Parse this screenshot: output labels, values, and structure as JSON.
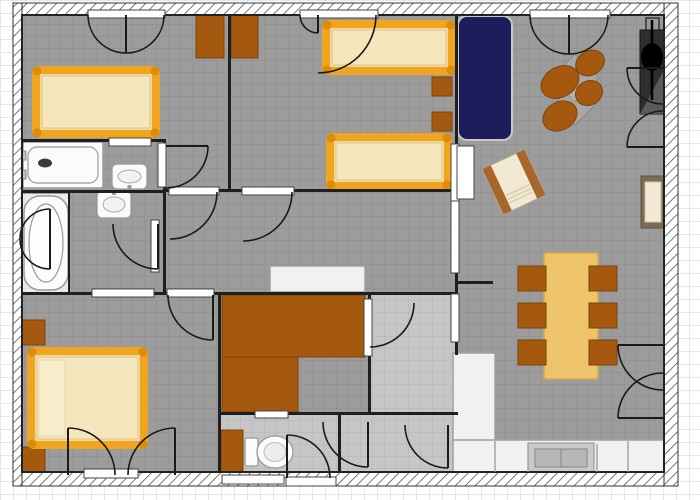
{
  "palette": {
    "paper": "#ffffff",
    "floor": "#9c9c9c",
    "floor_light": "#c6c6c6",
    "niche": "#ececec",
    "wall": "#1f1f1f",
    "hatch_line": "#555555",
    "wood": "#a4590f",
    "wood_dark": "#7d4408",
    "bed_frame": "#f0a41f",
    "bed_knob": "#dd8d05",
    "mattress": "#efd9a4",
    "mattress_light": "#f5e6bd",
    "pillow": "#f8edcb",
    "sofa": "#1d1d5c",
    "sofa_edge": "#c9c9c9",
    "table": "#edc469",
    "cream": "#f1e9d3",
    "arm_brown": "#a9662b",
    "chair_frame": "#7d6b58",
    "fixture": "#fbfbfb",
    "fixture_stroke": "#999999",
    "counter": "#f1f1f1",
    "counter_stroke": "#a0a0a0",
    "sink_gray": "#c9c9c9",
    "sink_gray2": "#b7b7b7",
    "dark_obj": "#2e2e2e",
    "black": "#000000",
    "door_line": "#1a1a1a",
    "threshold": "#ffffff",
    "threshold_stroke": "#444444",
    "grid_line": "rgba(0,0,0,0.09)"
  },
  "floorplan": {
    "canvas": {
      "width": 700,
      "height": 500
    },
    "exterior_walls": [
      {
        "name": "wall-top",
        "x": 13,
        "y": 3,
        "w": 665,
        "h": 12
      },
      {
        "name": "wall-bottom",
        "x": 13,
        "y": 472,
        "w": 665,
        "h": 14
      },
      {
        "name": "wall-left",
        "x": 13,
        "y": 3,
        "w": 9,
        "h": 483
      },
      {
        "name": "wall-right",
        "x": 664,
        "y": 3,
        "w": 14,
        "h": 483
      }
    ],
    "floors": [
      {
        "name": "floor-main",
        "x": 22,
        "y": 15,
        "w": 642,
        "h": 457,
        "fill": "floor"
      },
      {
        "name": "floor-bath-niche",
        "x": 22,
        "y": 194,
        "w": 47,
        "h": 98,
        "fill": "niche"
      },
      {
        "name": "floor-utility",
        "x": 371,
        "y": 295,
        "w": 84,
        "h": 117,
        "fill": "floor_light"
      },
      {
        "name": "floor-lobby",
        "x": 341,
        "y": 415,
        "w": 114,
        "h": 57,
        "fill": "floor_light"
      },
      {
        "name": "floor-wc",
        "x": 221,
        "y": 415,
        "w": 117,
        "h": 57,
        "fill": "floor_light"
      }
    ],
    "interior_walls": [
      {
        "name": "wall-bed1-bed2",
        "x": 228,
        "y": 15,
        "w": 3,
        "h": 176
      },
      {
        "name": "wall-beds-living",
        "x": 455,
        "y": 15,
        "w": 3,
        "h": 340
      },
      {
        "name": "wall-bed1-bath1",
        "x": 22,
        "y": 139,
        "w": 144,
        "h": 3
      },
      {
        "name": "wall-bath1-bath2",
        "x": 22,
        "y": 190,
        "w": 144,
        "h": 3
      },
      {
        "name": "wall-bath-vestibule",
        "x": 163,
        "y": 139,
        "w": 3,
        "h": 156
      },
      {
        "name": "wall-hall-top",
        "x": 166,
        "y": 189,
        "w": 292,
        "h": 3
      },
      {
        "name": "wall-hall-bottom",
        "x": 22,
        "y": 292,
        "w": 436,
        "h": 3
      },
      {
        "name": "wall-bed3-wc",
        "x": 218,
        "y": 292,
        "w": 3,
        "h": 188
      },
      {
        "name": "wall-storage-utility",
        "x": 368,
        "y": 292,
        "w": 3,
        "h": 123
      },
      {
        "name": "wall-storage-wc",
        "x": 218,
        "y": 412,
        "w": 240,
        "h": 3
      },
      {
        "name": "wall-wc-lobby",
        "x": 338,
        "y": 412,
        "w": 3,
        "h": 68
      },
      {
        "name": "wall-living-stub",
        "x": 455,
        "y": 281,
        "w": 38,
        "h": 3
      },
      {
        "name": "wall-tub-niche",
        "x": 68,
        "y": 191,
        "w": 2,
        "h": 101
      }
    ],
    "openings": [
      {
        "name": "threshold-bed1-terrace",
        "x": 88,
        "y": 10,
        "w": 77,
        "h": 8
      },
      {
        "name": "threshold-bed2-terrace",
        "x": 300,
        "y": 10,
        "w": 78,
        "h": 8
      },
      {
        "name": "threshold-living-terrace",
        "x": 530,
        "y": 10,
        "w": 80,
        "h": 8
      },
      {
        "name": "towel-rail-bath1",
        "x": 109,
        "y": 138,
        "w": 42,
        "h": 8
      },
      {
        "name": "threshold-bath1-door",
        "x": 158,
        "y": 143,
        "w": 8,
        "h": 44
      },
      {
        "name": "threshold-bed1-hall",
        "x": 169,
        "y": 187,
        "w": 50,
        "h": 8
      },
      {
        "name": "threshold-bed2-hall",
        "x": 242,
        "y": 187,
        "w": 52,
        "h": 8
      },
      {
        "name": "threshold-bath2-door",
        "x": 151,
        "y": 220,
        "w": 8,
        "h": 52
      },
      {
        "name": "threshold-bath2-bed3",
        "x": 92,
        "y": 289,
        "w": 62,
        "h": 8
      },
      {
        "name": "threshold-bed3-hall",
        "x": 167,
        "y": 289,
        "w": 47,
        "h": 8
      },
      {
        "name": "threshold-living-upper",
        "x": 451,
        "y": 144,
        "w": 8,
        "h": 57
      },
      {
        "name": "threshold-hall-living",
        "x": 451,
        "y": 201,
        "w": 8,
        "h": 72
      },
      {
        "name": "threshold-utility-dining",
        "x": 451,
        "y": 294,
        "w": 8,
        "h": 48
      },
      {
        "name": "threshold-storage-utility",
        "x": 364,
        "y": 299,
        "w": 8,
        "h": 57
      },
      {
        "name": "jamb-living-upper",
        "x": 457,
        "y": 146,
        "w": 17,
        "h": 53
      },
      {
        "name": "threshold-bed3-terrace",
        "x": 84,
        "y": 469,
        "w": 54,
        "h": 9
      },
      {
        "name": "window-bottom-1",
        "x": 222,
        "y": 475,
        "w": 62,
        "h": 9
      },
      {
        "name": "window-bottom-2",
        "x": 286,
        "y": 477,
        "w": 50,
        "h": 9
      },
      {
        "name": "shelf-wc",
        "x": 255,
        "y": 411,
        "w": 33,
        "h": 7
      }
    ],
    "doors": [
      {
        "name": "door-bed1-terrace-left",
        "hx": 126,
        "hy": 15,
        "r": 38,
        "a1": 90,
        "a2": 180,
        "leaf": true
      },
      {
        "name": "door-bed1-terrace-right",
        "hx": 126,
        "hy": 15,
        "r": 38,
        "a1": 90,
        "a2": 0,
        "leaf": false
      },
      {
        "name": "door-bed2-terrace-left",
        "hx": 318,
        "hy": 15,
        "r": 18,
        "a1": 90,
        "a2": 180,
        "leaf": true
      },
      {
        "name": "door-bed2-terrace-right",
        "hx": 318,
        "hy": 15,
        "r": 58,
        "a1": 90,
        "a2": 0,
        "leaf": false
      },
      {
        "name": "door-living-terrace-left",
        "hx": 569,
        "hy": 15,
        "r": 39,
        "a1": 90,
        "a2": 180,
        "leaf": true
      },
      {
        "name": "door-living-terrace-right",
        "hx": 569,
        "hy": 15,
        "r": 39,
        "a1": 90,
        "a2": 0,
        "leaf": false
      },
      {
        "name": "door-bed1-hall",
        "hx": 170,
        "hy": 192,
        "r": 47,
        "a1": 0,
        "a2": 90,
        "leaf": false
      },
      {
        "name": "door-bed2-hall",
        "hx": 243,
        "hy": 192,
        "r": 49,
        "a1": 0,
        "a2": 90,
        "leaf": false
      },
      {
        "name": "door-bath1",
        "hx": 166,
        "hy": 146,
        "r": 42,
        "a1": 0,
        "a2": 90,
        "leaf": true
      },
      {
        "name": "door-bath2",
        "hx": 158,
        "hy": 224,
        "r": 45,
        "a1": 90,
        "a2": 180,
        "leaf": true
      },
      {
        "name": "screen-tub-upper",
        "hx": 50,
        "hy": 239,
        "r": 30,
        "a1": 270,
        "a2": 180,
        "leaf": true
      },
      {
        "name": "screen-tub-lower",
        "hx": 50,
        "hy": 239,
        "r": 30,
        "a1": 90,
        "a2": 180,
        "leaf": true
      },
      {
        "name": "door-bed3-hall",
        "hx": 213,
        "hy": 295,
        "r": 45,
        "a1": 90,
        "a2": 180,
        "leaf": true
      },
      {
        "name": "door-bed3-terrace-left",
        "hx": 68,
        "hy": 475,
        "r": 47,
        "a1": 270,
        "a2": 0,
        "leaf": true
      },
      {
        "name": "door-bed3-terrace-right",
        "hx": 175,
        "hy": 475,
        "r": 47,
        "a1": 270,
        "a2": 180,
        "leaf": true
      },
      {
        "name": "door-wc",
        "hx": 287,
        "hy": 478,
        "r": 43,
        "a1": 270,
        "a2": 0,
        "leaf": true
      },
      {
        "name": "door-lobby-1",
        "hx": 368,
        "hy": 422,
        "r": 45,
        "a1": 90,
        "a2": 180,
        "leaf": true
      },
      {
        "name": "door-lobby-2",
        "hx": 448,
        "hy": 425,
        "r": 43,
        "a1": 90,
        "a2": 180,
        "leaf": true
      },
      {
        "name": "door-storage-utility",
        "hx": 370,
        "hy": 303,
        "r": 44,
        "a1": 0,
        "a2": 90,
        "leaf": false
      },
      {
        "name": "door-dining-right-top",
        "hx": 663,
        "hy": 345,
        "r": 45,
        "a1": 180,
        "a2": 90,
        "leaf": true
      },
      {
        "name": "door-dining-right-bottom",
        "hx": 663,
        "hy": 418,
        "r": 45,
        "a1": 180,
        "a2": 270,
        "leaf": true
      },
      {
        "name": "door-living-right-top",
        "hx": 663,
        "hy": 68,
        "r": 36,
        "a1": 180,
        "a2": 90,
        "leaf": true
      },
      {
        "name": "door-living-right-bottom",
        "hx": 663,
        "hy": 147,
        "r": 36,
        "a1": 180,
        "a2": 270,
        "leaf": true
      }
    ],
    "furniture": [
      {
        "name": "wardrobe-bed1",
        "type": "wrect",
        "x": 196,
        "y": 13,
        "w": 28,
        "h": 45
      },
      {
        "name": "wardrobe-bed2",
        "type": "wrect",
        "x": 231,
        "y": 13,
        "w": 27,
        "h": 45
      },
      {
        "name": "bed-double-1",
        "type": "bed",
        "x": 32,
        "y": 66,
        "w": 128,
        "h": 72
      },
      {
        "name": "bed-single-1",
        "type": "bed",
        "x": 322,
        "y": 20,
        "w": 134,
        "h": 55
      },
      {
        "name": "bed-single-2",
        "type": "bed",
        "x": 326,
        "y": 133,
        "w": 126,
        "h": 57
      },
      {
        "name": "nightstand-1",
        "type": "wrect",
        "x": 432,
        "y": 77,
        "w": 20,
        "h": 19
      },
      {
        "name": "nightstand-2",
        "type": "wrect",
        "x": 432,
        "y": 112,
        "w": 20,
        "h": 19
      },
      {
        "name": "sofa",
        "type": "sofa",
        "x": 458,
        "y": 16,
        "w": 54,
        "h": 124
      },
      {
        "name": "side-table-1",
        "type": "sqout",
        "cx": 575,
        "cy": 78,
        "s": 34,
        "rot": 45
      },
      {
        "name": "side-table-2",
        "type": "sqout",
        "cx": 575,
        "cy": 104,
        "s": 30,
        "rot": 45
      },
      {
        "name": "lounge-chair-1",
        "type": "oval",
        "cx": 560,
        "cy": 82,
        "rx": 20,
        "ry": 15,
        "rot": -30
      },
      {
        "name": "lounge-chair-2",
        "type": "oval",
        "cx": 590,
        "cy": 63,
        "rx": 15,
        "ry": 12,
        "rot": -30
      },
      {
        "name": "lounge-chair-3",
        "type": "oval",
        "cx": 589,
        "cy": 93,
        "rx": 14,
        "ry": 12,
        "rot": -30
      },
      {
        "name": "lounge-chair-4",
        "type": "oval",
        "cx": 560,
        "cy": 116,
        "rx": 18,
        "ry": 14,
        "rot": -30
      },
      {
        "name": "floor-lamp",
        "type": "lamp",
        "x": 640,
        "y": 30,
        "w": 24,
        "h": 84
      },
      {
        "name": "armchair-rotated",
        "type": "armchair",
        "cx": 514,
        "cy": 182,
        "w": 46,
        "h": 50,
        "rot": -25
      },
      {
        "name": "armchair-wall",
        "type": "sidechair",
        "x": 641,
        "y": 176,
        "w": 24,
        "h": 52
      },
      {
        "name": "bathtub-rect",
        "type": "tubr",
        "x": 23,
        "y": 142,
        "w": 80,
        "h": 46
      },
      {
        "name": "sink-bath1",
        "type": "sink",
        "x": 112,
        "y": 164,
        "w": 35,
        "h": 25,
        "tap": "bottom"
      },
      {
        "name": "bathtub-oval",
        "type": "tubo",
        "x": 24,
        "y": 196,
        "w": 44,
        "h": 94
      },
      {
        "name": "sink-bath2",
        "type": "sink",
        "x": 97,
        "y": 191,
        "w": 34,
        "h": 27,
        "tap": "top"
      },
      {
        "name": "hall-dresser",
        "type": "crect",
        "x": 270,
        "y": 266,
        "w": 95,
        "h": 26
      },
      {
        "name": "nightstand-3",
        "type": "wrect",
        "x": 21,
        "y": 320,
        "w": 24,
        "h": 25
      },
      {
        "name": "nightstand-4",
        "type": "wrect",
        "x": 21,
        "y": 447,
        "w": 24,
        "h": 25
      },
      {
        "name": "bed-double-2",
        "type": "bed",
        "x": 27,
        "y": 347,
        "w": 121,
        "h": 102,
        "pillow": true
      },
      {
        "name": "closet-top",
        "type": "wrect",
        "x": 222,
        "y": 295,
        "w": 143,
        "h": 62
      },
      {
        "name": "closet-bottom",
        "type": "wrect",
        "x": 222,
        "y": 357,
        "w": 76,
        "h": 55
      },
      {
        "name": "wc-cabinet",
        "type": "wrect",
        "x": 221,
        "y": 430,
        "w": 22,
        "h": 48
      },
      {
        "name": "toilet",
        "type": "toilet",
        "x": 245,
        "y": 438
      },
      {
        "name": "dining-table",
        "type": "table",
        "x": 544,
        "y": 253,
        "w": 54,
        "h": 126
      },
      {
        "name": "dining-chair-1",
        "type": "wrect",
        "x": 518,
        "y": 266,
        "w": 28,
        "h": 25
      },
      {
        "name": "dining-chair-2",
        "type": "wrect",
        "x": 518,
        "y": 303,
        "w": 28,
        "h": 25
      },
      {
        "name": "dining-chair-3",
        "type": "wrect",
        "x": 518,
        "y": 340,
        "w": 28,
        "h": 25
      },
      {
        "name": "dining-chair-4",
        "type": "wrect",
        "x": 589,
        "y": 266,
        "w": 28,
        "h": 25
      },
      {
        "name": "dining-chair-5",
        "type": "wrect",
        "x": 589,
        "y": 303,
        "w": 28,
        "h": 25
      },
      {
        "name": "dining-chair-6",
        "type": "wrect",
        "x": 589,
        "y": 340,
        "w": 28,
        "h": 25
      },
      {
        "name": "kitchen-counter-tall",
        "type": "crect",
        "x": 453,
        "y": 353,
        "w": 42,
        "h": 88
      },
      {
        "name": "kitchen-counter-run",
        "type": "crect",
        "x": 453,
        "y": 440,
        "w": 212,
        "h": 33
      },
      {
        "name": "kitchen-sink",
        "type": "ksink",
        "x": 528,
        "y": 443,
        "w": 66,
        "h": 30
      }
    ],
    "lines": [
      {
        "name": "counter-divider-1",
        "x1": 495,
        "y1": 441,
        "x2": 495,
        "y2": 472
      },
      {
        "name": "counter-divider-2",
        "x1": 528,
        "y1": 444,
        "x2": 528,
        "y2": 472
      },
      {
        "name": "counter-divider-3",
        "x1": 597,
        "y1": 444,
        "x2": 597,
        "y2": 472
      },
      {
        "name": "counter-divider-4",
        "x1": 628,
        "y1": 441,
        "x2": 628,
        "y2": 472
      }
    ]
  }
}
